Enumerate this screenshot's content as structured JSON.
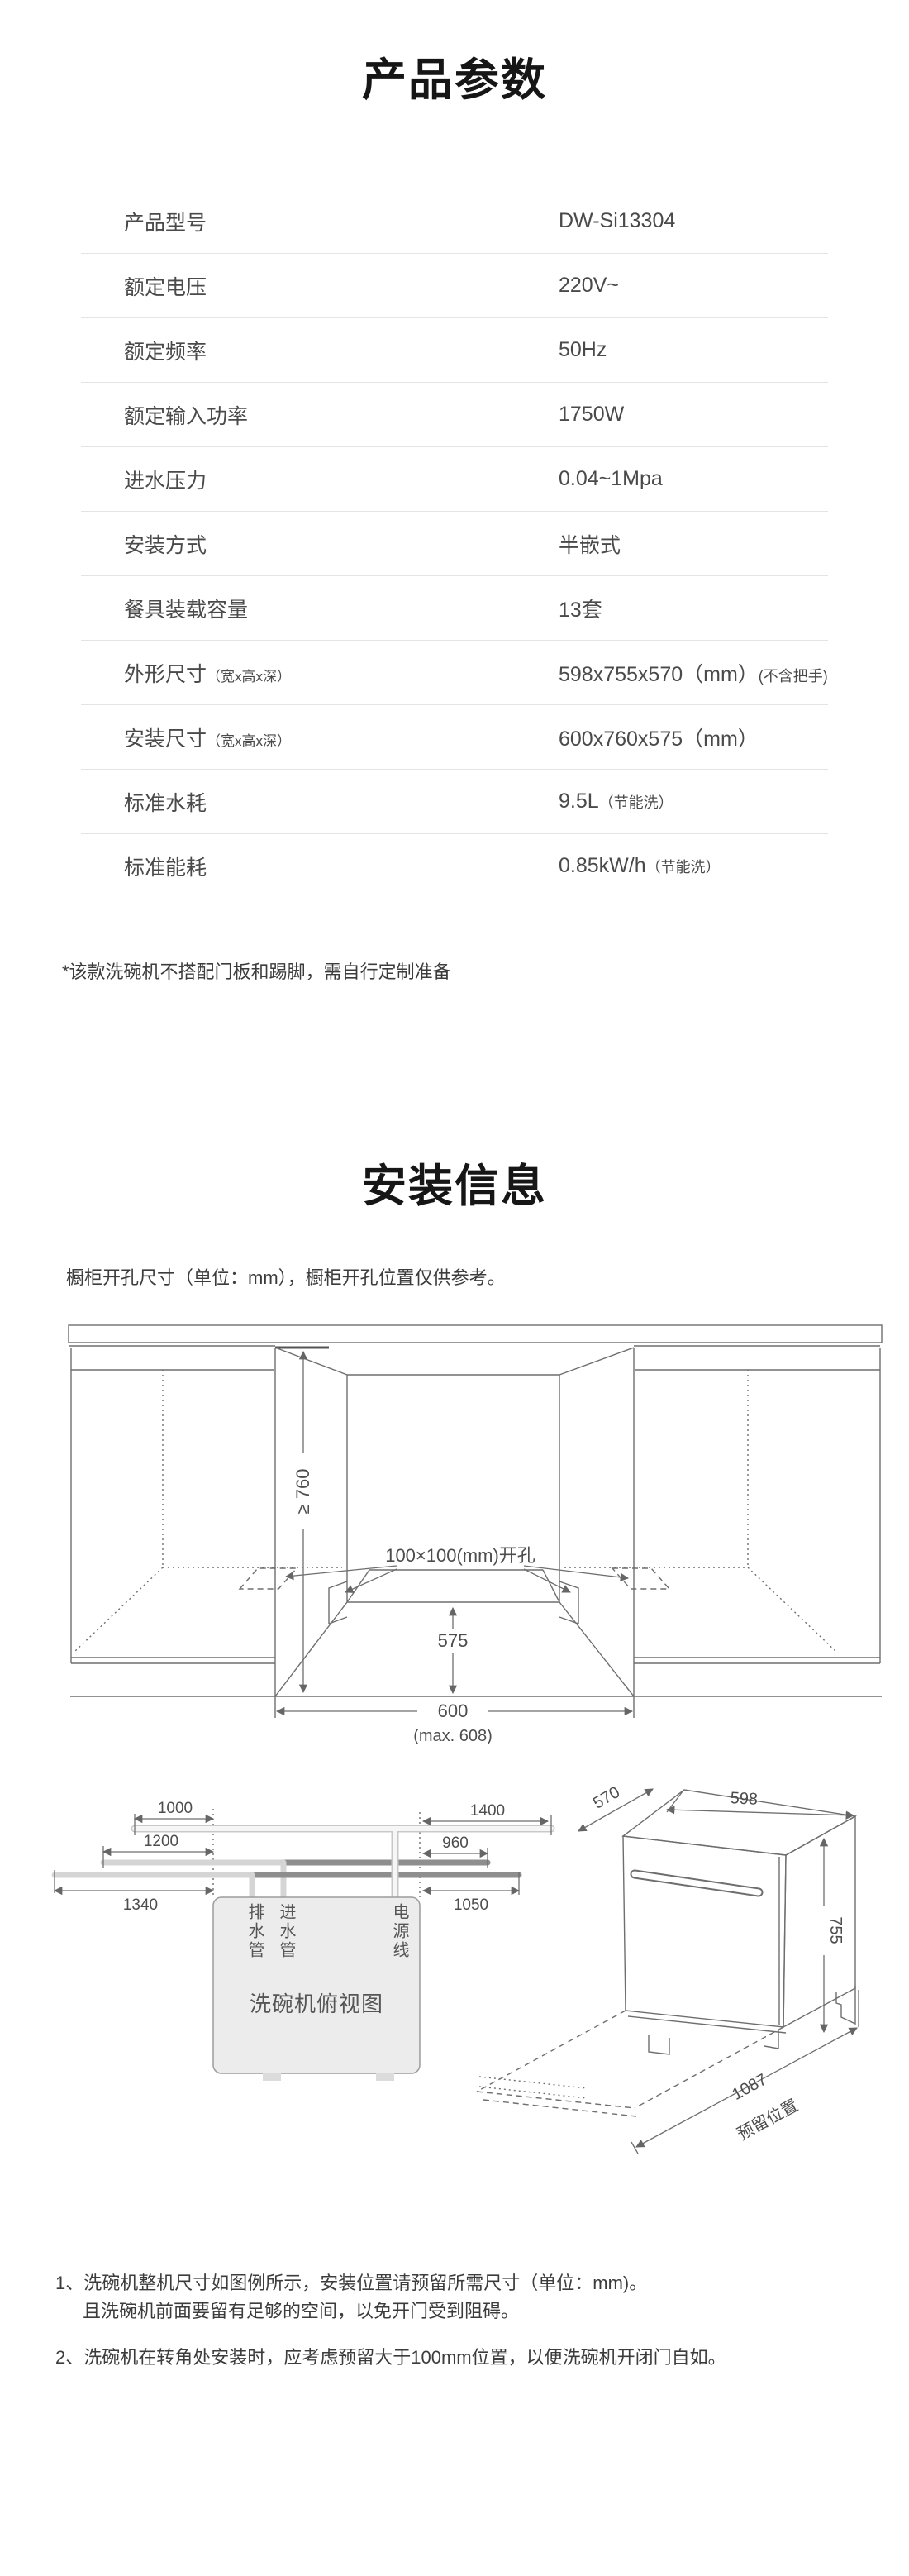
{
  "product_params": {
    "title": "产品参数",
    "rows": [
      {
        "label": "产品型号",
        "value": "DW-Si13304"
      },
      {
        "label": "额定电压",
        "value": "220V~"
      },
      {
        "label": "额定频率",
        "value": "50Hz"
      },
      {
        "label": "额定输入功率",
        "value": "1750W"
      },
      {
        "label": "进水压力",
        "value": "0.04~1Mpa"
      },
      {
        "label": "安装方式",
        "value": "半嵌式"
      },
      {
        "label": "餐具装载容量",
        "value": "13套"
      },
      {
        "label": "外形尺寸",
        "label_note": "（宽x高x深）",
        "value": "598x755x570（mm）",
        "value_note": "(不含把手)"
      },
      {
        "label": "安装尺寸",
        "label_note": "（宽x高x深）",
        "value": "600x760x575（mm）"
      },
      {
        "label": "标准水耗",
        "value": "9.5L",
        "value_note": "（节能洗）"
      },
      {
        "label": "标准能耗",
        "value": "0.85kW/h",
        "value_note": "（节能洗）"
      }
    ],
    "footnote": "*该款洗碗机不搭配门板和踢脚，需自行定制准备"
  },
  "install_info": {
    "title": "安装信息",
    "subtitle": "橱柜开孔尺寸（单位：mm），橱柜开孔位置仅供参考。",
    "cabinet_diagram": {
      "height_dim": "≥ 760",
      "hole_label": "100×100(mm)开孔",
      "depth_dim": "575",
      "width_dim": "600",
      "width_max": "(max. 608)"
    },
    "topview_diagram": {
      "left_dims": [
        "1000",
        "1200",
        "1340"
      ],
      "right_dims": [
        "1400",
        "960",
        "1050"
      ],
      "pipe_labels": [
        "排水管",
        "进水管",
        "电源线"
      ],
      "caption": "洗碗机俯视图"
    },
    "machine_diagram": {
      "depth_dim": "570",
      "width_dim": "598",
      "height_dim": "755",
      "reserve_dim": "1087",
      "reserve_label": "预留位置"
    },
    "notes": [
      "1、洗碗机整机尺寸如图例所示，安装位置请预留所需尺寸（单位：mm)。",
      "且洗碗机前面要留有足够的空间，以免开门受到阻碍。",
      "2、洗碗机在转角处安装时，应考虑预留大于100mm位置，以便洗碗机开闭门自如。"
    ]
  }
}
